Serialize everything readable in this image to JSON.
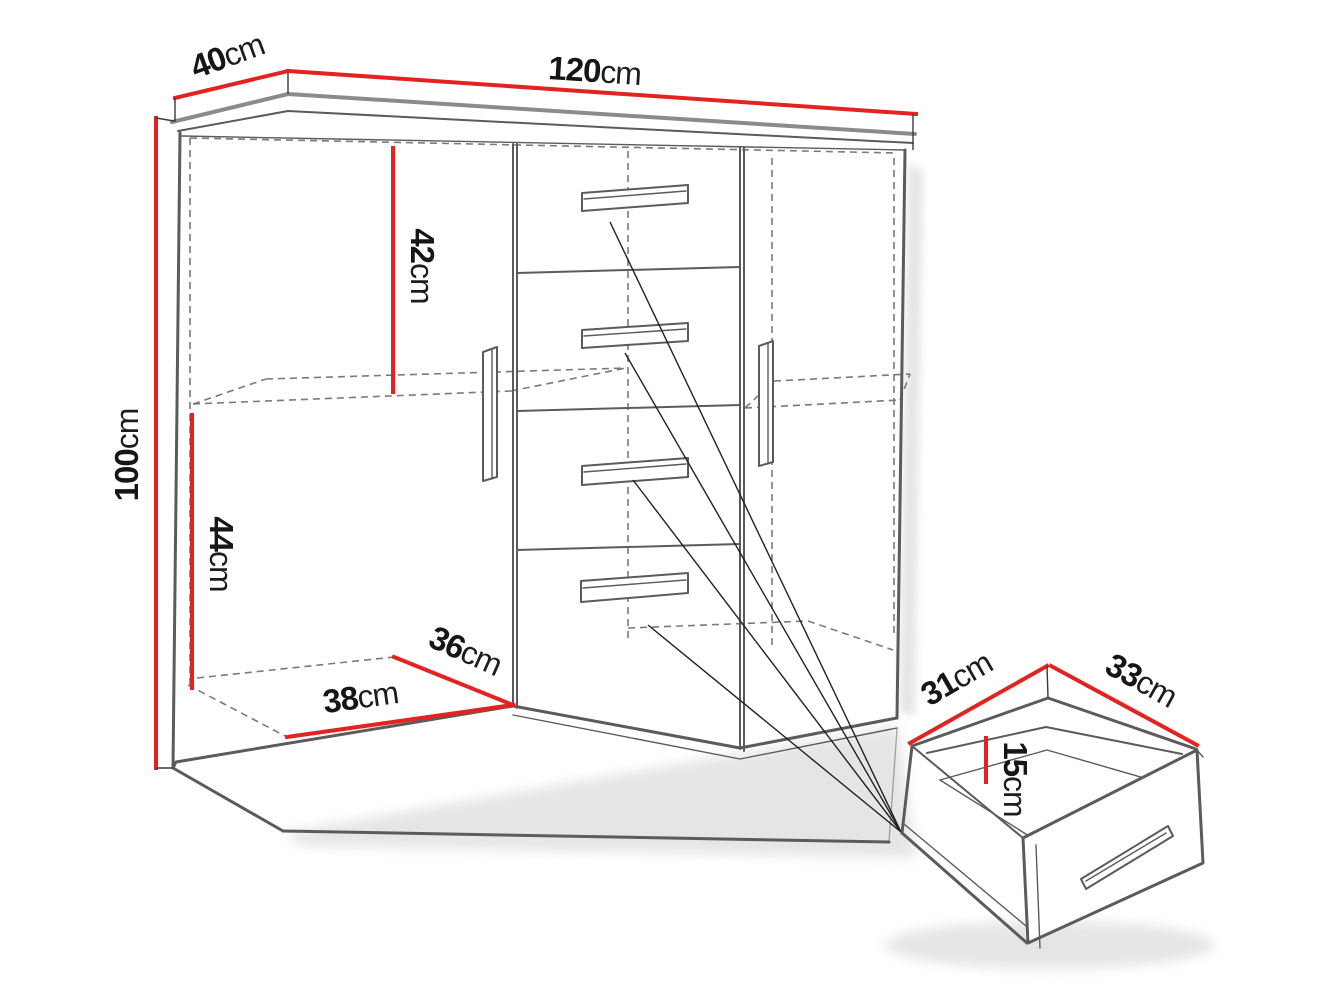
{
  "diagram_type": "furniture-dimension-diagram",
  "dimensions": {
    "top_depth": {
      "value": "40",
      "unit": "cm"
    },
    "top_width": {
      "value": "120",
      "unit": "cm"
    },
    "height": {
      "value": "100",
      "unit": "cm"
    },
    "upper_section_height": {
      "value": "42",
      "unit": "cm"
    },
    "lower_section_height": {
      "value": "44",
      "unit": "cm"
    },
    "interior_depth": {
      "value": "36",
      "unit": "cm"
    },
    "interior_width": {
      "value": "38",
      "unit": "cm"
    },
    "drawer_depth": {
      "value": "31",
      "unit": "cm"
    },
    "drawer_width": {
      "value": "33",
      "unit": "cm"
    },
    "drawer_height": {
      "value": "15",
      "unit": "cm"
    }
  },
  "colors": {
    "dimension_line": "#e42320",
    "outline": "#5b5b5b",
    "dashed_line": "#7a7a7a",
    "text": "#161616"
  }
}
